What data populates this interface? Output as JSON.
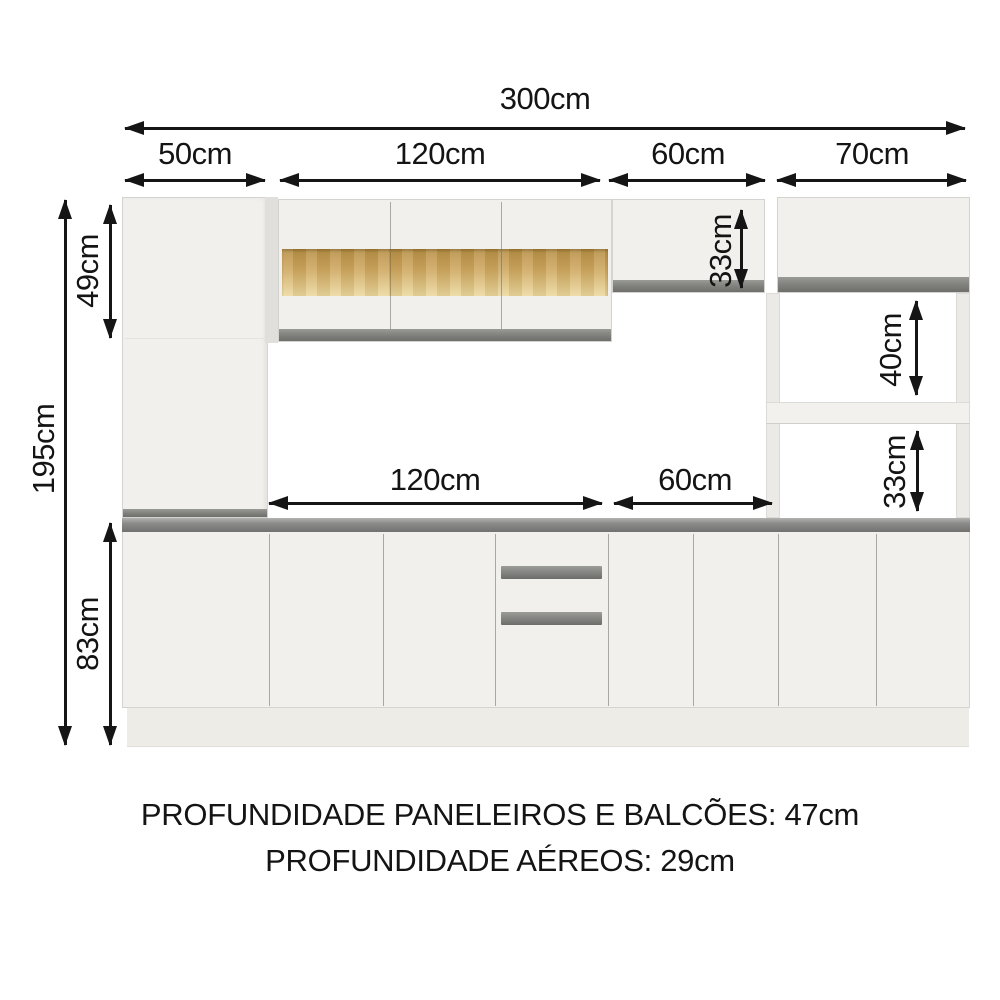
{
  "page": {
    "background": "#ffffff"
  },
  "colors": {
    "annotation": "#141414",
    "cabinet_body": "#f1f0ec",
    "cabinet_edge": "#d4d3cf",
    "handle_gray": "#82827f",
    "counter_gray": "#8d8d8b",
    "plinth": "#edece7",
    "wood_band_top": "#b78f46",
    "wood_band_bottom": "#ecd9a0"
  },
  "dimensions": {
    "total_width": "300cm",
    "section_paneleiro": "50cm",
    "section_aereo_center": "120cm",
    "section_aereo_flap": "60cm",
    "section_tower": "70cm",
    "total_height": "195cm",
    "upper_section_height": "49cm",
    "base_section_height": "83cm",
    "counter_span_center": "120cm",
    "counter_span_flap": "60cm",
    "flap_cabinet_height": "33cm",
    "niche_top_height": "40cm",
    "niche_bottom_height": "33cm"
  },
  "footer": {
    "depth_line_1": "PROFUNDIDADE PANELEIROS E BALCÕES: 47cm",
    "depth_line_2": "PROFUNDIDADE AÉREOS: 29cm"
  }
}
